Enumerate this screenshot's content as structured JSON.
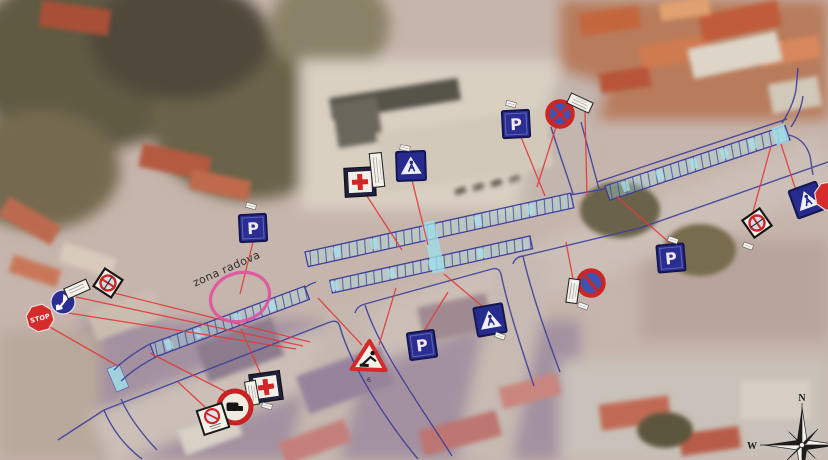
{
  "document": {
    "type": "traffic-signalization-plan-over-aerial-photo",
    "work_zone_label": "zona radova"
  },
  "labels": {
    "stop": "STOP",
    "parking": "P",
    "roadworks_pole_number": "6"
  },
  "compass": {
    "north_label": "N",
    "west_label": "W"
  },
  "plan_colors": {
    "plan_line_blue": "#3f3f9b",
    "crosswalk_cyan": "#9fdde8",
    "leader_line_red": "#e23c3c",
    "work_zone_highlight_pink": "#e0519d",
    "sign_navy": "#2a2e92",
    "sign_red": "#d42a2a"
  },
  "signs": [
    {
      "id": "stop-sign-west",
      "type": "stop"
    },
    {
      "id": "mandatory-direction-sign",
      "type": "mandatory-direction"
    },
    {
      "id": "supplementary-plate-west",
      "type": "supplementary-plate"
    },
    {
      "id": "end-of-no-parking-zone-sign",
      "type": "no-parking-diamond"
    },
    {
      "id": "parking-sign-1",
      "type": "parking"
    },
    {
      "id": "first-aid-sign-1",
      "type": "first-aid"
    },
    {
      "id": "pedestrian-crossing-sign-1",
      "type": "pedestrian-crossing"
    },
    {
      "id": "parking-sign-2",
      "type": "parking"
    },
    {
      "id": "no-stopping-sign",
      "type": "no-stopping"
    },
    {
      "id": "parking-sign-3",
      "type": "parking"
    },
    {
      "id": "no-parking-diamond-east",
      "type": "no-parking-diamond"
    },
    {
      "id": "pedestrian-crossing-sign-2",
      "type": "pedestrian-crossing"
    },
    {
      "id": "stop-sign-east-edge",
      "type": "stop-partial"
    },
    {
      "id": "no-parking-sign-east",
      "type": "no-parking"
    },
    {
      "id": "pedestrian-crossing-sign-3",
      "type": "pedestrian-crossing"
    },
    {
      "id": "parking-sign-4",
      "type": "parking"
    },
    {
      "id": "roadworks-sign",
      "type": "roadworks-warning"
    },
    {
      "id": "first-aid-sign-2",
      "type": "first-aid"
    },
    {
      "id": "no-trucks-sign",
      "type": "no-trucks"
    },
    {
      "id": "no-parking-zone-sign",
      "type": "no-parking-zone"
    }
  ]
}
